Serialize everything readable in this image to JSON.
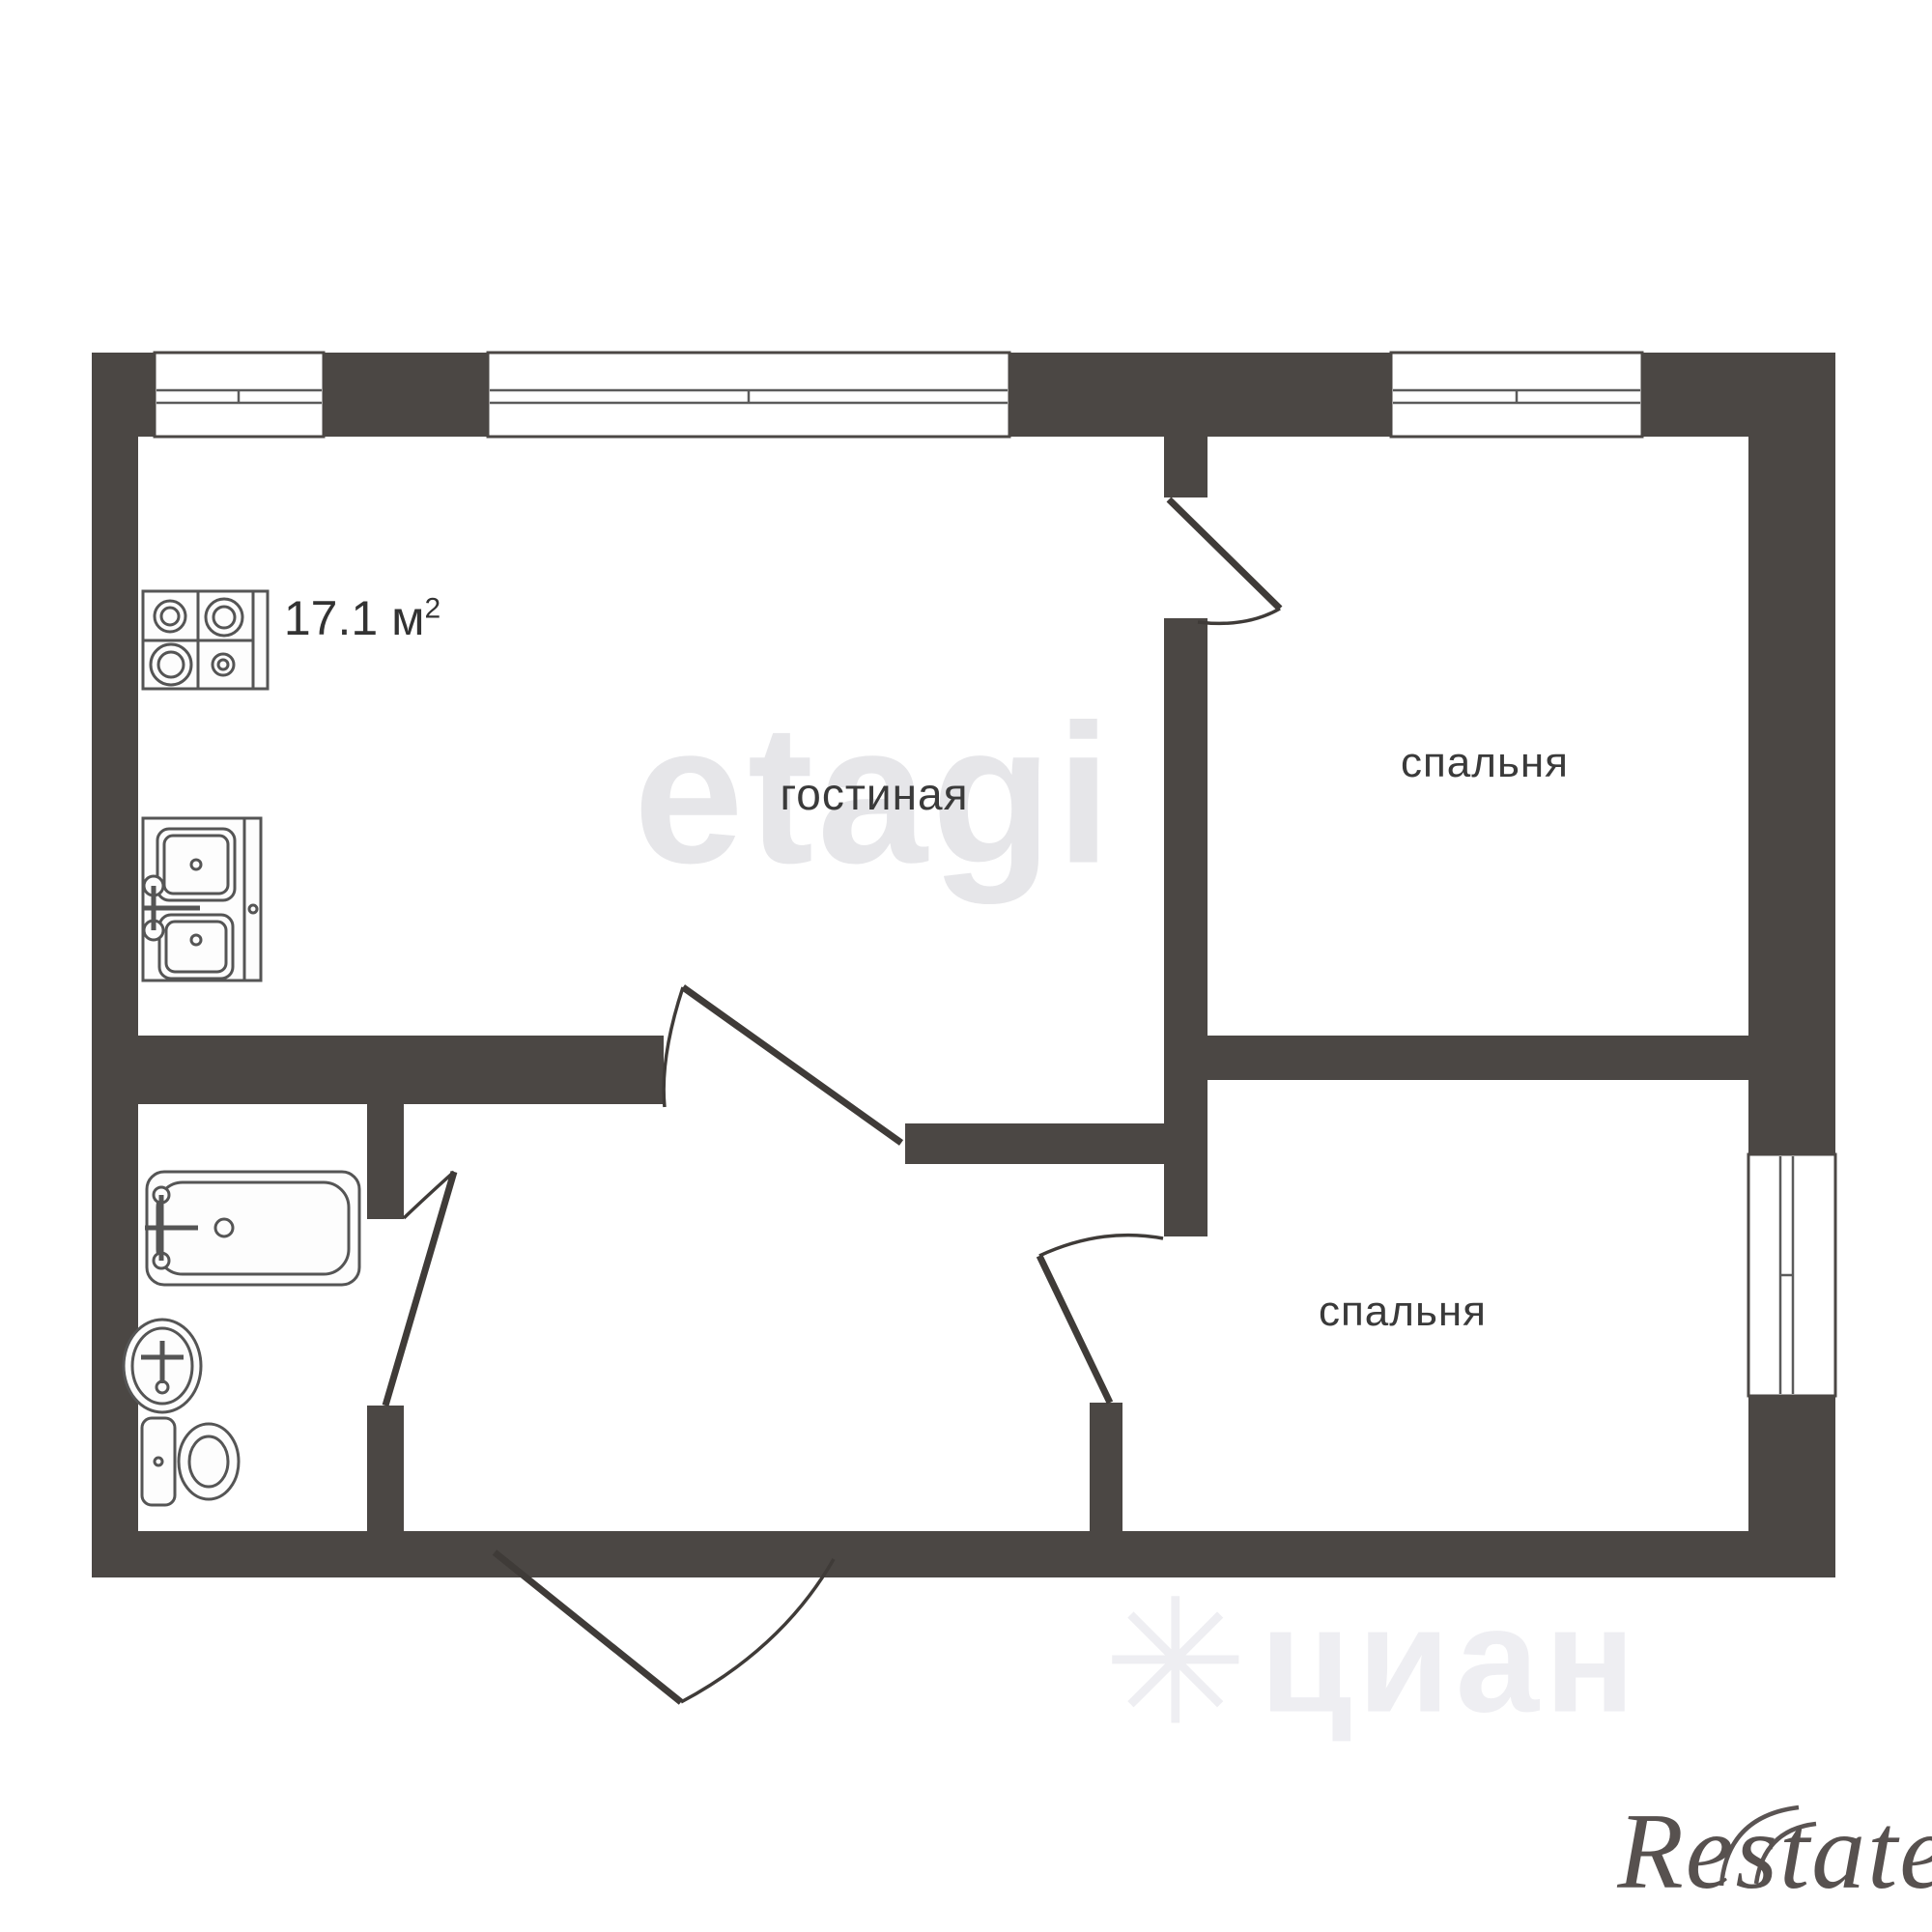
{
  "plan": {
    "area_label": {
      "value": "17.1 м",
      "sup": "2"
    },
    "rooms": [
      {
        "id": "living-room",
        "label": "гостиная"
      },
      {
        "id": "bedroom-top",
        "label": "спальня"
      },
      {
        "id": "bedroom-bottom",
        "label": "спальня"
      }
    ],
    "fixtures": [
      {
        "name": "stove-icon"
      },
      {
        "name": "kitchen-sink-icon"
      },
      {
        "name": "bathtub-icon"
      },
      {
        "name": "washbasin-icon"
      },
      {
        "name": "toilet-icon"
      }
    ],
    "openings": [
      {
        "name": "bedroom-top-door"
      },
      {
        "name": "living-room-door"
      },
      {
        "name": "bathroom-door"
      },
      {
        "name": "bedroom-bottom-door"
      },
      {
        "name": "entrance-door"
      }
    ],
    "windows_count": 4
  },
  "watermarks": {
    "etagi": "etagi",
    "cian_asterisk": "✳",
    "cian": "циан",
    "restate": "Restate"
  },
  "colors": {
    "wall": "#4b4744",
    "wm-strong": "#e6e6e9",
    "wm-faint": "#eeeef2"
  }
}
